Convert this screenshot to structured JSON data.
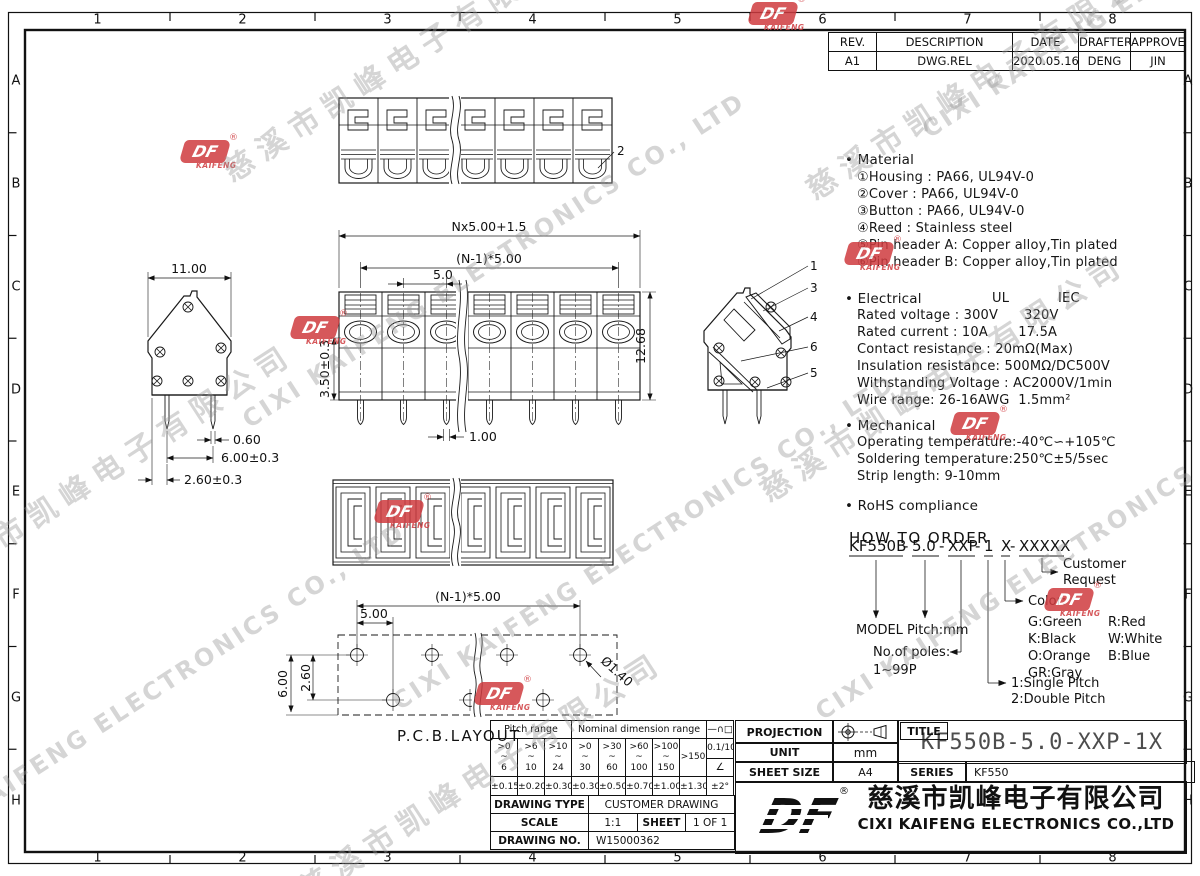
{
  "frame": {
    "cols": [
      "1",
      "2",
      "3",
      "4",
      "5",
      "6",
      "7",
      "8"
    ],
    "rows": [
      "A",
      "B",
      "C",
      "D",
      "E",
      "F",
      "G",
      "H"
    ]
  },
  "revision": {
    "headers": [
      "REV.",
      "DESCRIPTION",
      "DATE",
      "DRAFTER",
      "APPROVER"
    ],
    "row": [
      "A1",
      "DWG.REL",
      "2020.05.16",
      "DENG",
      "JIN"
    ]
  },
  "notes": {
    "material_title": "• Material",
    "material": [
      "①Housing : PA66, UL94V-0",
      "②Cover : PA66, UL94V-0",
      "③Button : PA66, UL94V-0",
      "④Reed : Stainless steel",
      "⑤Pin header A: Copper alloy,Tin plated",
      "⑥Pin header B: Copper alloy,Tin plated"
    ],
    "electrical_title": "• Electrical",
    "electrical_ul": "UL",
    "electrical_iec": "IEC",
    "electrical": [
      "Rated voltage : 300V      320V",
      "Rated current : 10A       17.5A",
      "Contact resistance : 20mΩ(Max)",
      "Insulation resistance: 500MΩ/DC500V",
      "Withstanding Voltage : AC2000V/1min",
      "Wire range: 26-16AWG  1.5mm²"
    ],
    "mechanical_title": "• Mechanical",
    "mechanical": [
      "Operating temperature:-40℃∽+105℃",
      "Soldering temperature:250℃±5/5sec",
      "Strip length: 9-10mm"
    ],
    "rohs": "• RoHS compliance"
  },
  "order": {
    "title": "HOW TO ORDER",
    "code_parts": [
      "KF550B",
      "5.0",
      "XXP",
      "1",
      "X",
      "XXXXX"
    ],
    "sep": "-",
    "customer1": "Customer",
    "customer2": "Request",
    "color_label": "Color:",
    "colors": [
      "G:Green",
      "R:Red",
      "K:Black",
      "W:White",
      "O:Orange",
      "B:Blue",
      "GR:Gray"
    ],
    "model": "MODEL Pitch:mm",
    "poles1": "No.of poles:",
    "poles2": "1~99P",
    "pitch1": "1:Single Pitch",
    "pitch2": "2:Double Pitch"
  },
  "dims": {
    "top_callout": "2",
    "front_total": "Nx5.00+1.5",
    "front_pitch": "(N-1)*5.00",
    "front_one": "5.0",
    "front_h": "12.68",
    "front_pin_len": "3.50±0.3",
    "front_pin_w": "1.00",
    "side_w": "11.00",
    "side_pin_w": "0.60",
    "side_pin_span": "6.00±0.3",
    "side_edge": "2.60±0.3",
    "callouts": [
      "1",
      "3",
      "4",
      "6",
      "5"
    ],
    "pcb_pitch": "(N-1)*5.00",
    "pcb_first": "5.00",
    "pcb_h": "6.00",
    "pcb_off": "2.60",
    "pcb_hole": "Ø1.40",
    "pcb_label": "P.C.B.LAYOUT"
  },
  "tol_table": {
    "pitch_header": "Pitch range",
    "nominal_header": "Nominal dimension range",
    "sym_header": "—∩□",
    "ranges": [
      ">0\n~\n6",
      ">6\n~\n10",
      ">10\n~\n24",
      ">0\n~\n30",
      ">30\n~\n60",
      ">60\n~\n100",
      ">100\n~\n150",
      ">150"
    ],
    "sym_top": "0.1/10",
    "sym_bottom": "∠",
    "tols": [
      "±0.15",
      "±0.20",
      "±0.30",
      "±0.30",
      "±0.50",
      "±0.70",
      "±1.00",
      "±1.30",
      "±2°"
    ]
  },
  "info": {
    "drawing_type_label": "DRAWING TYPE",
    "drawing_type": "CUSTOMER DRAWING",
    "scale_label": "SCALE",
    "scale": "1:1",
    "sheet_label": "SHEET",
    "sheet": "1 OF 1",
    "drawing_no_label": "DRAWING NO.",
    "drawing_no": "W15000362"
  },
  "title_block": {
    "projection_label": "PROJECTION",
    "unit_label": "UNIT",
    "unit": "mm",
    "sheet_size_label": "SHEET SIZE",
    "sheet_size": "A4",
    "title_label": "TITLE",
    "title": "KF550B-5.0-XXP-1X",
    "series_label": "SERIES",
    "series": "KF550",
    "company_zh": "慈溪市凯峰电子有限公司",
    "company_en": "CIXI KAIFENG ELECTRONICS CO.,LTD",
    "reg": "®",
    "logo_text": "DF"
  },
  "watermark": {
    "zh": "慈溪市凯峰电子有限公司",
    "en": "CIXI KAIFENG ELECTRONICS CO., LTD",
    "logo_df": "DF",
    "logo_sub": "KAIFENG"
  }
}
